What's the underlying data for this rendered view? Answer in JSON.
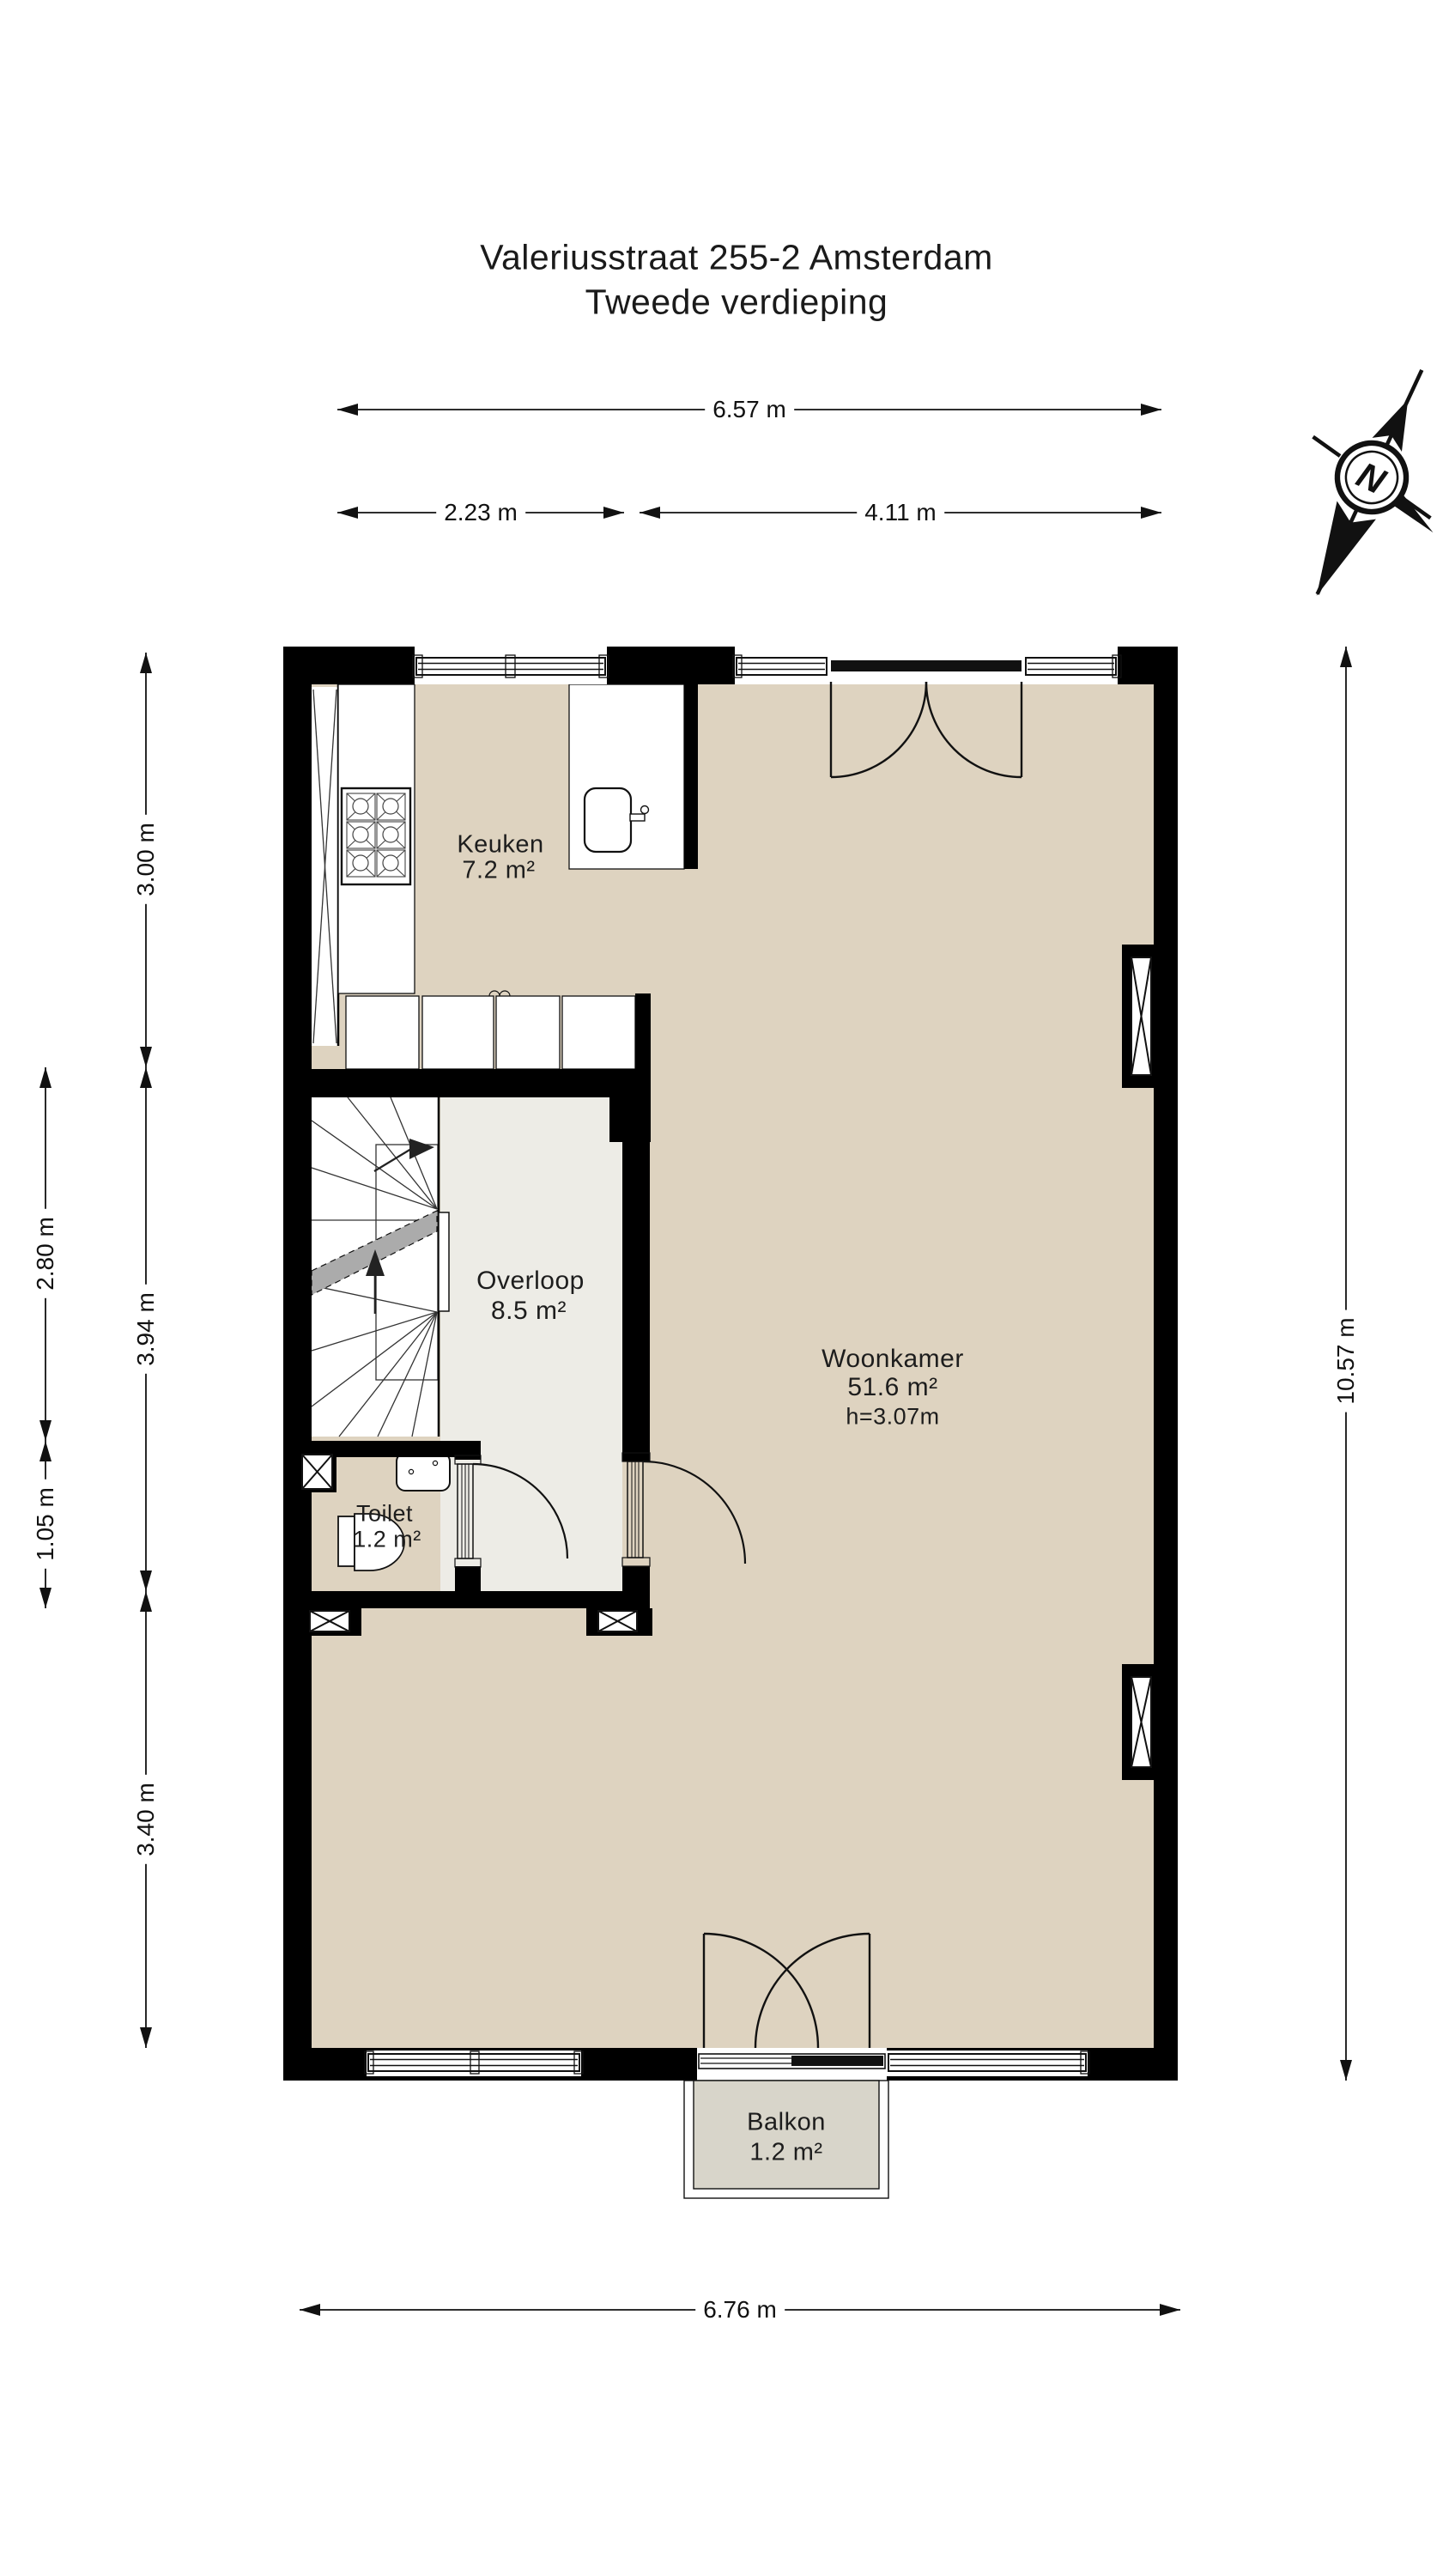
{
  "title": {
    "line1": "Valeriusstraat 255-2 Amsterdam",
    "line2": "Tweede verdieping"
  },
  "compass": {
    "label": "N"
  },
  "dimensions": {
    "top_total": "6.57 m",
    "top_left": "2.23 m",
    "top_right": "4.11 m",
    "left_inner_upper": "3.00 m",
    "left_inner_middle": "3.94 m",
    "left_inner_lower": "3.40 m",
    "left_outer_upper": "2.80 m",
    "left_outer_lower": "1.05 m",
    "right_total": "10.57 m",
    "bottom_total": "6.76 m"
  },
  "rooms": {
    "keuken": {
      "name": "Keuken",
      "area": "7.2 m²"
    },
    "overloop": {
      "name": "Overloop",
      "area": "8.5 m²"
    },
    "woonkamer": {
      "name": "Woonkamer",
      "area": "51.6 m²",
      "height": "h=3.07m"
    },
    "toilet": {
      "name": "Toilet",
      "area": "1.2 m²"
    },
    "balkon": {
      "name": "Balkon",
      "area": "1.2 m²"
    }
  },
  "colors": {
    "wall": "#000000",
    "floor": "#ded3c0",
    "overloop": "#edece6",
    "balkon": "#d8d5ca",
    "band": "#ababab",
    "line": "#111111",
    "text": "#1d1d1d"
  }
}
